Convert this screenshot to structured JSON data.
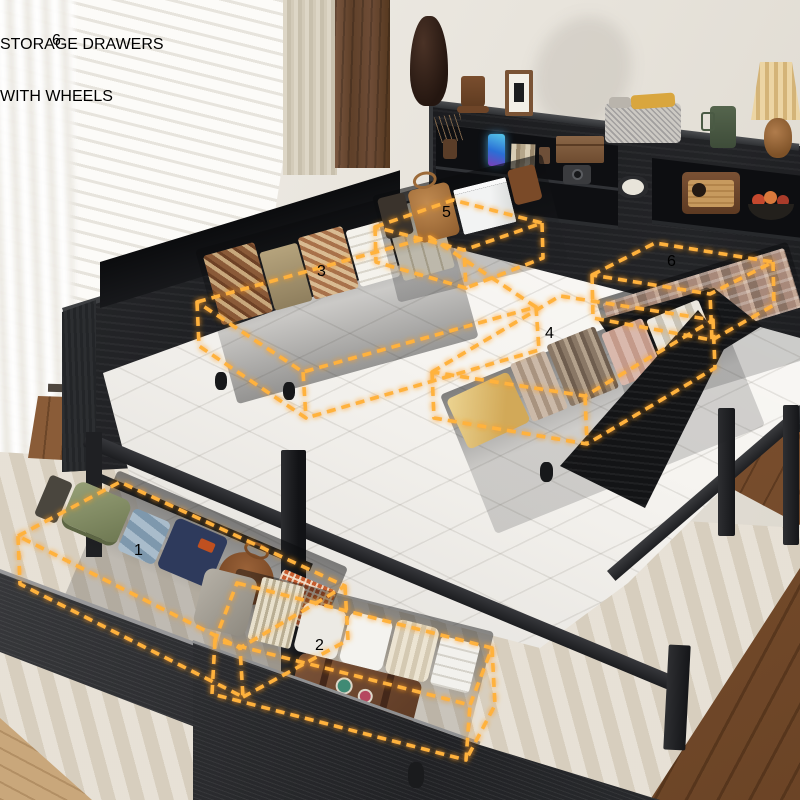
{
  "header": {
    "count_badge": "6",
    "title_line1": "STORAGE DRAWERS",
    "title_line2": "WITH WHEELS"
  },
  "callouts": [
    {
      "number": "1"
    },
    {
      "number": "2"
    },
    {
      "number": "3"
    },
    {
      "number": "4"
    },
    {
      "number": "5"
    },
    {
      "number": "6"
    }
  ],
  "colors": {
    "accent_orange": "#f7941d",
    "callout_orange": "#f68a10",
    "outline_glow": "#ffaa2e",
    "title_teal": "#2e6a72",
    "furniture_black": "#1d1e20",
    "mattress_white": "#f5f3ef",
    "rug_beige": "#ded5c6",
    "wood_floor_dark": "#7c5233",
    "wood_floor_light": "#c9a77b"
  }
}
